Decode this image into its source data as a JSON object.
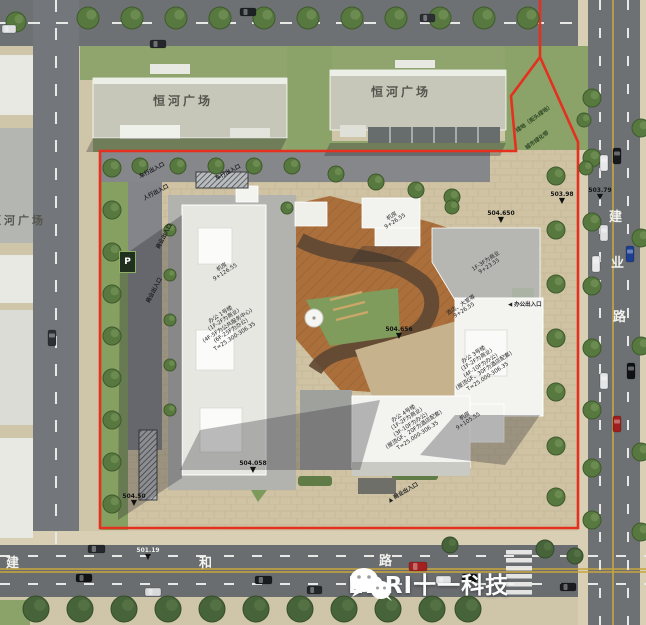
{
  "neighbors": {
    "plaza_top_left": "恒河广场",
    "plaza_top_right": "恒河广场",
    "plaza_west": "恒河广场"
  },
  "roads": {
    "south": {
      "chars": [
        "建",
        "和",
        "路"
      ]
    },
    "east": {
      "chars": [
        "建",
        "业",
        "路"
      ]
    }
  },
  "elevation_markers": {
    "ne_road": "503.98",
    "ne_site": "504.650",
    "east_road": "503.79",
    "center_plaza": "504.656",
    "south_plaza": "504.058",
    "sw_ramp": "504.50",
    "south_road": "501.19"
  },
  "buildings": {
    "tower1": {
      "lines": [
        "办公 1号楼",
        "(1F-2F为商业)",
        "(4F-5F为公共服务中心)",
        "(6F-25F为办公)",
        "T≈25.300-306.35"
      ]
    },
    "tower3": {
      "lines": [
        "办公 3号楼",
        "(1F-2F为商业)",
        "(4F-10F为办公)",
        "(屋顶GF、30F为酒店配套)",
        "T≈25.000-306.35"
      ]
    },
    "tower4": {
      "lines": [
        "办公 4号楼",
        "(1F-2F为商业)",
        "(3F-10F为办公)",
        "(屋顶GF、20F为酒店配套)",
        "T≈25.000-306.35"
      ]
    },
    "roof_room_top": {
      "lines": [
        "机房",
        "9+26.55"
      ]
    },
    "roof_room_t1": {
      "lines": [
        "机房",
        "9+126.55"
      ]
    },
    "roof_room_t34": {
      "lines": [
        "机房",
        "9+105.55"
      ]
    },
    "podium_retail": {
      "lines": [
        "1F-3F为商业",
        "9+23.55"
      ]
    },
    "hotel_lobby": {
      "lines": [
        "酒店、大堂等",
        "9+26.55"
      ]
    }
  },
  "entrances": {
    "vehicle_n1": "车行出入口",
    "pedestrian_n": "人行出入口",
    "vehicle_n2": "车行出入口",
    "retail_w1": "商业出入口",
    "retail_w2": "商业出入口",
    "retail_s": "商业出入口",
    "office_e": "办公出入口"
  },
  "green_labels": {
    "street_green": "绿地（街头绿地）",
    "city_green_belt": "城市绿化带"
  },
  "parking_sign": "P",
  "watermark": {
    "brand": "EDRI十一科技"
  },
  "icons": {
    "level_marker": "▼",
    "arrow_left": "◀",
    "arrow_up": "▲"
  },
  "colors": {
    "boundary_red": "#e5301f",
    "road_gray": "#6e7174",
    "paving_tan": "#cfc3a4",
    "lawn_green": "#8ba268",
    "deck_terracotta": "#ab6f3c"
  }
}
